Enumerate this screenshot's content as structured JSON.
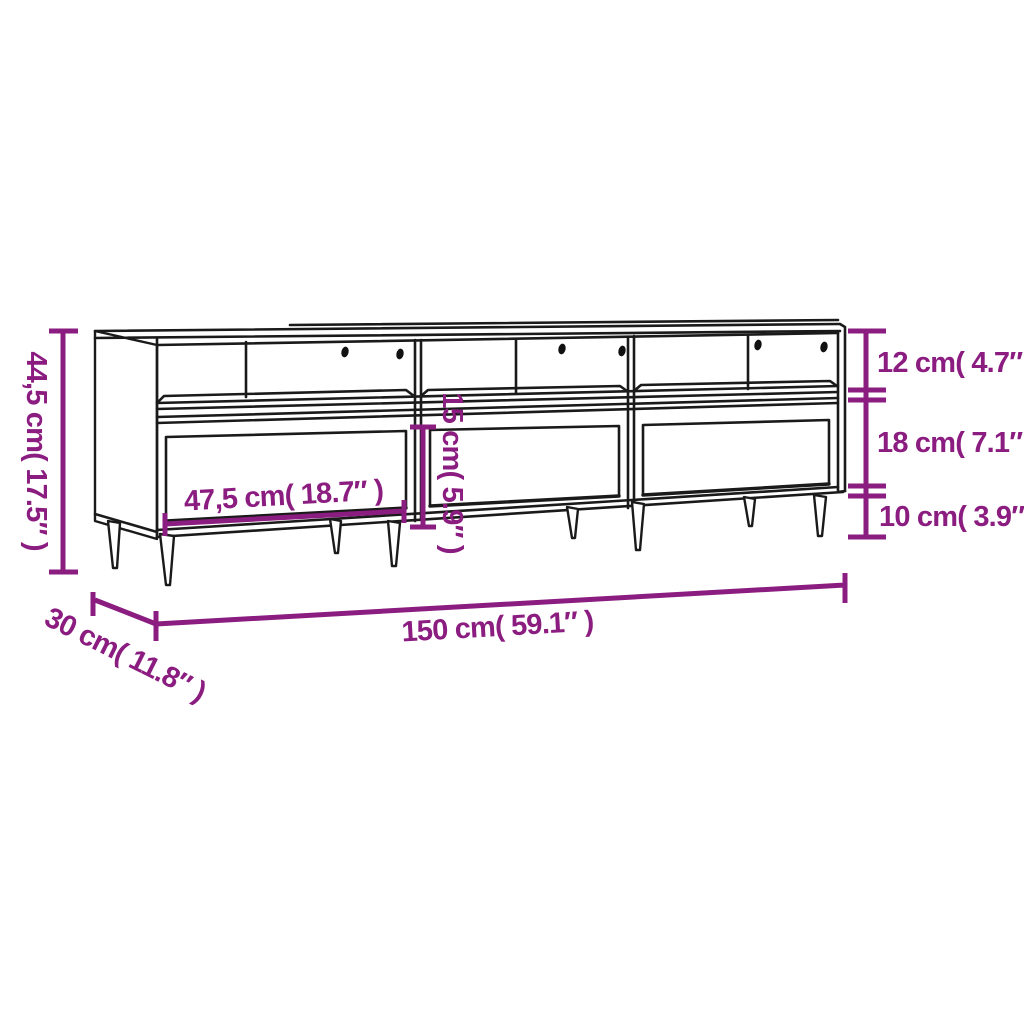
{
  "diagram": {
    "colors": {
      "accent": "#8B1C80",
      "line": "#1A1A1A",
      "background": "#FFFFFF"
    },
    "labels": {
      "overall_height": "44,5 cm( 17.5″ )",
      "top_compartment_height": "12 cm( 4.7″ )",
      "drawer_front_height": "18 cm( 7.1″ )",
      "leg_height": "10 cm( 3.9″ )",
      "drawer_opening_height": "15 cm( 5.9″ )",
      "compartment_width": "47,5 cm( 18.7″ )",
      "overall_width": "150 cm( 59.1″ )",
      "overall_depth": "30 cm( 11.8″ )"
    }
  }
}
